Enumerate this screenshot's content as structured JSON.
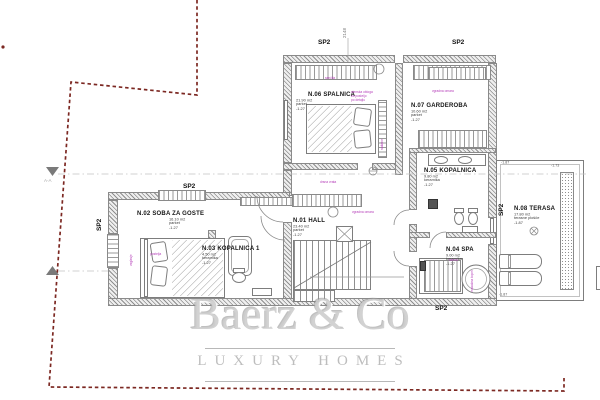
{
  "watermark": {
    "brand": "Baerz & Co",
    "tagline": "LUXURY HOMES"
  },
  "section_label": "A-A",
  "zones": {
    "sp2": "SP2"
  },
  "rooms": [
    {
      "name": "N.01 HALL",
      "area": "23.40 m2",
      "floor": "parket",
      "elevation": "-1.27"
    },
    {
      "name": "N.02 SOBA ZA GOSTE",
      "area": "16.10 m2",
      "floor": "parket",
      "elevation": "-1.27"
    },
    {
      "name": "N.03 KOPALNICA 1",
      "area": "4.50 m2",
      "floor": "keramika",
      "elevation": "-1.27"
    },
    {
      "name": "N.04 SPA",
      "area": "9.00 m2",
      "floor": "keramika",
      "elevation": "-1.27"
    },
    {
      "name": "N.05 KOPALNICA",
      "area": "9.80 m2",
      "floor": "keramika",
      "elevation": "-1.27"
    },
    {
      "name": "N.06 SPALNICA",
      "area": "21.90 m2",
      "floor": "parket",
      "elevation": "-1.27"
    },
    {
      "name": "N.07 GARDEROBA",
      "area": "10.60 m2",
      "floor": "parket",
      "elevation": "-1.27"
    },
    {
      "name": "N.08 TERASA",
      "area": "17.80 m2",
      "floor": "terasne plošče",
      "elevation": "-1.87"
    }
  ],
  "elevation_marks": {
    "terrace_top_left": "-1.87",
    "terrace_top_right": "-1.73",
    "terrace_bottom": "-1.87"
  },
  "annotations": {
    "shutter": "senčila",
    "wardrobe": "vgradna omara",
    "closet_top": "drsna vrata",
    "closet_side": "vgradna omara",
    "bedroom_note_1": "stenska obloga",
    "bedroom_note_2": "za posteljo",
    "bedroom_note_3": "po detajlu",
    "radiator": "radiator",
    "guest_bed_side": "vzglavje",
    "guest_bed": "postelja",
    "sauna": "savna",
    "tub": "masažna kopel"
  },
  "dimensions": {
    "top_middle": "2148"
  },
  "colors": {
    "boundary": "#7c2822",
    "annotation": "#b43cb8",
    "wall": "#8a8a8a",
    "watermark": "#c9c9c9"
  }
}
